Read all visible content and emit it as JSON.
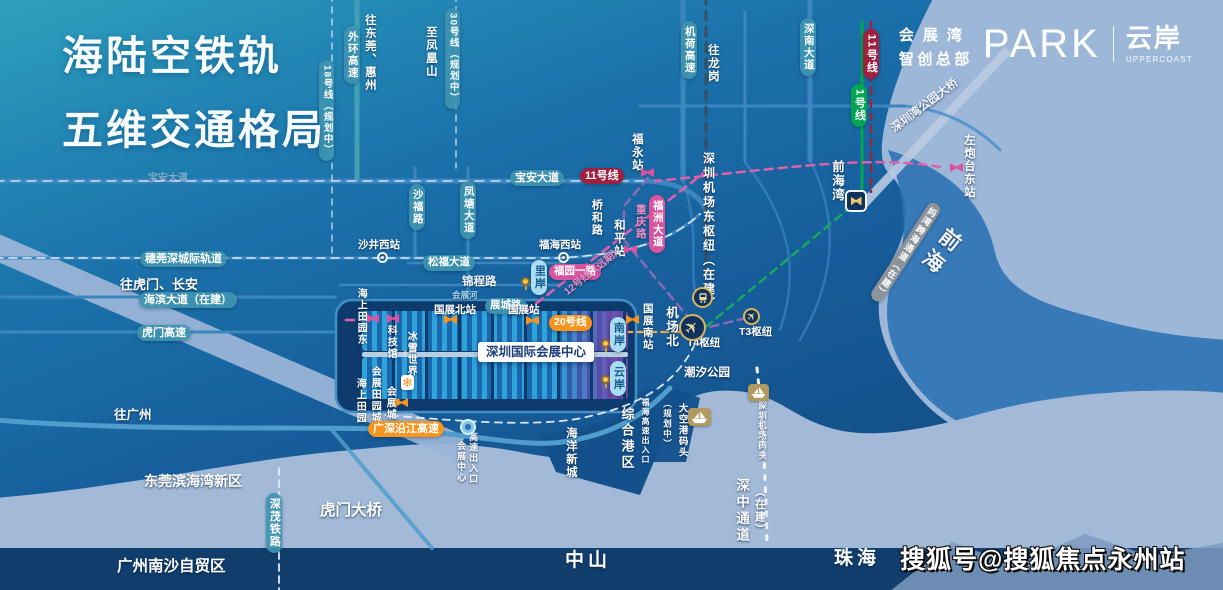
{
  "title": {
    "line1": "海陆空铁轨",
    "line2": "五维交通格局"
  },
  "logo": {
    "line1": "会展湾",
    "line2": "智创总部",
    "park": "PARK",
    "cn2": "云岸",
    "en": "UPPERCOAST"
  },
  "watermark": "搜狐号@搜狐焦点永州站",
  "colors": {
    "sky_teal": "#2fa0bd",
    "land_blue": "#175f9d",
    "sea_light": "#9db7d9",
    "dark_block": "#0d3b6e",
    "road_blue": "#3c86c0",
    "line11_red": "#9e2140",
    "line1_green": "#00a651",
    "line20_orange": "#f7941d",
    "line12_pink": "#d9549f",
    "purple_line": "#8a6bb5",
    "gray_pill": "#8d939a",
    "project_pill": "#aadcf2",
    "gold_icon": "#d9b35e"
  },
  "map": {
    "labels": [
      {
        "n": "waihuan-expwy-pill",
        "t": "外环高速",
        "c": "tl",
        "v": 1,
        "x": 344,
        "y": 26,
        "fs": 10.5
      },
      {
        "n": "line18-pill",
        "t": "18号线（规划中）",
        "c": "tl",
        "v": 1,
        "x": 319,
        "y": 60,
        "fs": 9.5
      },
      {
        "n": "to-dongguan-huizhou-text",
        "t": "往东莞、惠州",
        "c": "tx",
        "v": 1,
        "x": 363,
        "y": 14,
        "fs": 11.5
      },
      {
        "n": "line30-pill",
        "t": "30号线（规划中）",
        "c": "tl",
        "v": 1,
        "x": 445,
        "y": 8,
        "fs": 9.5
      },
      {
        "n": "to-fenghuangshan-text",
        "t": "至凤凰山",
        "c": "tx",
        "v": 1,
        "x": 424,
        "y": 26,
        "fs": 11.5
      },
      {
        "n": "jihe-expwy-pill",
        "t": "机荷高速",
        "c": "tl",
        "v": 1,
        "x": 681,
        "y": 21,
        "fs": 10.5
      },
      {
        "n": "to-longgang-text",
        "t": "往龙岗",
        "c": "tx",
        "v": 1,
        "x": 706,
        "y": 44,
        "fs": 11.5
      },
      {
        "n": "shennan-avenue-pill",
        "t": "深南大道",
        "c": "tl",
        "v": 1,
        "x": 800,
        "y": 18,
        "fs": 10.5
      },
      {
        "n": "line11-pill-vertical",
        "t": "11号线",
        "c": "rd",
        "v": 1,
        "x": 863,
        "y": 29,
        "fs": 11
      },
      {
        "n": "line1-pill",
        "t": "1号线",
        "c": "gn",
        "v": 1,
        "x": 851,
        "y": 84,
        "fs": 11
      },
      {
        "n": "shenzhenwan-park-bridge-text",
        "t": "深圳湾公园大桥",
        "c": "tx",
        "x": 893,
        "y": 124,
        "fs": 11.5,
        "rot": -37,
        "op": 0.9
      },
      {
        "n": "qianhai-sea-text",
        "t": "前海",
        "c": "tx",
        "v": 1,
        "x": 944,
        "y": 230,
        "fs": 21,
        "ls": 6,
        "rot": 38,
        "op": 0.92
      },
      {
        "n": "zuopaotaidong-station-text",
        "t": "左炮台东站",
        "c": "tx",
        "v": 1,
        "x": 962,
        "y": 134,
        "fs": 11.5
      },
      {
        "n": "qianhaiwan-station-text",
        "t": "前海湾",
        "c": "tx",
        "v": 1,
        "x": 830,
        "y": 160,
        "fs": 12.5
      },
      {
        "n": "mawan-crossing-pill",
        "t": "妈湾跨海通道（在建）",
        "c": "gy",
        "v": 1,
        "x": 930,
        "y": 204,
        "fs": 9,
        "rot": 33
      },
      {
        "n": "baoan-avenue-pill",
        "t": "宝安大道",
        "c": "tl",
        "x": 510,
        "y": 170,
        "fs": 11
      },
      {
        "n": "line11-pill-horizontal",
        "t": "11号线",
        "c": "rd",
        "x": 580,
        "y": 168,
        "fs": 11
      },
      {
        "n": "fuyong-station-text",
        "t": "福永站",
        "c": "tx",
        "v": 1,
        "x": 630,
        "y": 133,
        "fs": 11.5
      },
      {
        "n": "shafu-road-pill",
        "t": "沙福路",
        "c": "tl",
        "v": 1,
        "x": 409,
        "y": 184,
        "fs": 10.5
      },
      {
        "n": "fengtang-avenue-pill",
        "t": "凤塘大道",
        "c": "tl",
        "v": 1,
        "x": 460,
        "y": 181,
        "fs": 10.5
      },
      {
        "n": "qiaohe-road-text",
        "t": "桥和路",
        "c": "tx",
        "v": 1,
        "x": 590,
        "y": 199,
        "fs": 11
      },
      {
        "n": "chongqing-road-text",
        "t": "重庆路",
        "c": "tp",
        "v": 1,
        "x": 634,
        "y": 204,
        "fs": 10.5
      },
      {
        "n": "fuzhou-avenue-pill",
        "t": "福洲大道",
        "c": "pk",
        "v": 1,
        "x": 649,
        "y": 195,
        "fs": 10.5
      },
      {
        "n": "heping-station-text",
        "t": "和平站",
        "c": "tx",
        "v": 1,
        "x": 612,
        "y": 219,
        "fs": 11.5
      },
      {
        "n": "airport-east-hub-text",
        "t": "深圳机场东枢纽（在建）",
        "c": "tx",
        "v": 1,
        "x": 701,
        "y": 152,
        "fs": 12,
        "ls": 2.5
      },
      {
        "n": "suiwanshen-rail-pill",
        "t": "穗莞深城际轨道",
        "c": "tl",
        "x": 140,
        "y": 251,
        "fs": 11
      },
      {
        "n": "to-humen-changan-text",
        "t": "往虎门、长安",
        "c": "tx",
        "x": 120,
        "y": 278,
        "fs": 13
      },
      {
        "n": "haibin-avenue-pill",
        "t": "海滨大道（在建）",
        "c": "tl",
        "x": 139,
        "y": 292,
        "fs": 11
      },
      {
        "n": "humen-expwy-pill",
        "t": "虎门高速",
        "c": "tl",
        "x": 137,
        "y": 325,
        "fs": 11
      },
      {
        "n": "baoan-avenue-faint-text",
        "t": "宝安大道",
        "c": "tx",
        "x": 148,
        "y": 173,
        "fs": 10,
        "op": 0.4
      },
      {
        "n": "shajingxi-station-text",
        "t": "沙井西站",
        "c": "tx",
        "x": 358,
        "y": 240,
        "fs": 10.5
      },
      {
        "n": "fuhaixi-station-text",
        "t": "福海西站",
        "c": "tx",
        "x": 539,
        "y": 240,
        "fs": 10.5
      },
      {
        "n": "songfu-avenue-pill",
        "t": "松福大道",
        "c": "tl",
        "x": 423,
        "y": 255,
        "fs": 10.5
      },
      {
        "n": "jincheng-road-text",
        "t": "锦程路",
        "c": "tx",
        "x": 462,
        "y": 276,
        "fs": 11.5,
        "op": 0.95
      },
      {
        "n": "huizhan-river-text",
        "t": "会展河",
        "c": "ts",
        "x": 452,
        "y": 291,
        "fs": 8.5
      },
      {
        "n": "zhancheng-road-pill",
        "t": "展城路",
        "c": "tl",
        "x": 485,
        "y": 298,
        "fs": 10.5
      },
      {
        "n": "guozhanbei-station-text",
        "t": "国展北站",
        "c": "tx",
        "x": 434,
        "y": 305,
        "fs": 10.5
      },
      {
        "n": "guozhan-station-text",
        "t": "国展站",
        "c": "tx",
        "x": 508,
        "y": 305,
        "fs": 10.5
      },
      {
        "n": "line20-pill",
        "t": "20号线",
        "c": "or",
        "x": 549,
        "y": 315,
        "fs": 10.5
      },
      {
        "n": "guozhannan-station-text",
        "t": "国展南站",
        "c": "tx",
        "v": 1,
        "x": 641,
        "y": 303,
        "fs": 10.5
      },
      {
        "n": "fuyuan-yilu-pill",
        "t": "福园一路",
        "c": "pk",
        "x": 549,
        "y": 264,
        "fs": 10.5
      },
      {
        "n": "line12-future-label",
        "t": "12号线（远期）",
        "c": "tp",
        "x": 566,
        "y": 288,
        "fs": 10,
        "rot": -39
      },
      {
        "n": "haishangtianyuandong-station-text",
        "t": "海上田园东",
        "c": "tx",
        "v": 1,
        "x": 355,
        "y": 288,
        "fs": 10
      },
      {
        "n": "kejiguan-station-text",
        "t": "科技馆",
        "c": "tx",
        "v": 1,
        "x": 385,
        "y": 325,
        "fs": 10
      },
      {
        "n": "bingxueshijie-text",
        "t": "冰雪世界",
        "c": "tx",
        "v": 1,
        "x": 405,
        "y": 331,
        "fs": 10
      },
      {
        "n": "huizhantianyuancheng-text",
        "t": "会展田园城",
        "c": "tx",
        "v": 1,
        "x": 369,
        "y": 366,
        "fs": 10
      },
      {
        "n": "haishangtianyuan-text",
        "t": "海上田园",
        "c": "tx",
        "v": 1,
        "x": 354,
        "y": 378,
        "fs": 10
      },
      {
        "n": "huizhancheng-station-text",
        "t": "会展城",
        "c": "tx",
        "v": 1,
        "x": 384,
        "y": 386,
        "fs": 10
      },
      {
        "n": "convention-center-box",
        "t": "深圳国际会展中心",
        "c": "box",
        "x": 478,
        "y": 342
      },
      {
        "n": "lian-project-pill",
        "t": "里岸",
        "c": "lt",
        "v": 1,
        "x": 531,
        "y": 260,
        "fs": 11
      },
      {
        "n": "nanan-project-pill",
        "t": "南岸",
        "c": "lt",
        "v": 1,
        "x": 610,
        "y": 317,
        "fs": 11
      },
      {
        "n": "yunan-project-pill",
        "t": "云岸",
        "c": "lt",
        "v": 1,
        "x": 610,
        "y": 361,
        "fs": 11
      },
      {
        "n": "jichangbei-station-text",
        "t": "机场北",
        "c": "tx",
        "v": 1,
        "x": 664,
        "y": 306,
        "fs": 12.5
      },
      {
        "n": "t4-hub-text",
        "t": "T4枢纽",
        "c": "tx",
        "x": 687,
        "y": 338,
        "fs": 10.5
      },
      {
        "n": "t3-hub-text",
        "t": "T3枢纽",
        "c": "tx",
        "x": 739,
        "y": 327,
        "fs": 10.5
      },
      {
        "n": "chaoxi-park-text",
        "t": "潮汐公园",
        "c": "tx",
        "x": 684,
        "y": 367,
        "fs": 11.5
      },
      {
        "n": "guangshen-yanjiang-expwy-pill",
        "t": "广深沿江高速",
        "c": "or",
        "x": 368,
        "y": 421,
        "fs": 11
      },
      {
        "n": "expwy-exit-text",
        "t": "高速出入口",
        "c": "tx",
        "v": 1,
        "x": 468,
        "y": 432,
        "fs": 9
      },
      {
        "n": "expwy-exit-huizhan-text",
        "t": "会展中心",
        "c": "tx",
        "v": 1,
        "x": 456,
        "y": 441,
        "fs": 9
      },
      {
        "n": "haiyang-xincheng-text",
        "t": "海洋新城",
        "c": "tx",
        "v": 1,
        "x": 564,
        "y": 427,
        "fs": 11.5
      },
      {
        "n": "zonghe-gangqu-text",
        "t": "综合港区",
        "c": "tx",
        "v": 1,
        "x": 619,
        "y": 407,
        "fs": 13,
        "ls": 3
      },
      {
        "n": "fuhai-expwy-exit-text",
        "t": "福海高速出入口",
        "c": "tx",
        "v": 1,
        "x": 640,
        "y": 398,
        "fs": 8
      },
      {
        "n": "guihuazhong-text",
        "t": "（规划中）",
        "c": "tx",
        "v": 1,
        "x": 662,
        "y": 399,
        "fs": 8.5
      },
      {
        "n": "dakonggang-ferry-text",
        "t": "大空港码头",
        "c": "tx",
        "v": 1,
        "x": 676,
        "y": 403,
        "fs": 9.5
      },
      {
        "n": "airport-ferry-text",
        "t": "深圳机场码头",
        "c": "tx",
        "v": 1,
        "x": 757,
        "y": 401,
        "fs": 8.5
      },
      {
        "n": "shenzhong-corridor-text",
        "t": "深中通道",
        "c": "tx",
        "v": 1,
        "x": 734,
        "y": 478,
        "fs": 13.5,
        "ls": 3
      },
      {
        "n": "shenzhong-corridor-sub-text",
        "t": "（在建）",
        "c": "tx",
        "v": 1,
        "x": 753,
        "y": 486,
        "fs": 11
      },
      {
        "n": "shenmao-railway-pill",
        "t": "深茂铁路",
        "c": "tl",
        "v": 1,
        "x": 266,
        "y": 493,
        "fs": 11
      },
      {
        "n": "to-guangzhou-text",
        "t": "往广州",
        "c": "tx",
        "x": 114,
        "y": 408,
        "fs": 12.5
      },
      {
        "n": "dongguan-binhaiwan-text",
        "t": "东莞滨海湾新区",
        "c": "tx",
        "x": 144,
        "y": 474,
        "fs": 14
      },
      {
        "n": "humen-bridge-text",
        "t": "虎门大桥",
        "c": "tx",
        "x": 320,
        "y": 502,
        "fs": 15.5
      },
      {
        "n": "guangzhou-nansha-text",
        "t": "广州南沙自贸区",
        "c": "tx",
        "x": 117,
        "y": 558,
        "fs": 15.5
      },
      {
        "n": "zhongshan-city-text",
        "t": "中山",
        "c": "big",
        "x": 565,
        "y": 550
      },
      {
        "n": "zhuhai-city-text",
        "t": "珠海",
        "c": "big",
        "x": 834,
        "y": 548
      }
    ],
    "markers": [
      {
        "n": "fuyong-station-marker",
        "k": "x",
        "x": 641,
        "y": 168,
        "c": "#e0519f",
        "s": 13
      },
      {
        "n": "heping-station-marker",
        "k": "x",
        "x": 624,
        "y": 245,
        "c": "#e0519f",
        "s": 13
      },
      {
        "n": "zuopaotaidong-station-marker",
        "k": "x",
        "x": 950,
        "y": 163,
        "c": "#e0519f",
        "s": 13
      },
      {
        "n": "haishangtianyuandong-station-marker",
        "k": "x",
        "x": 367,
        "y": 314,
        "c": "#e0519f",
        "s": 12
      },
      {
        "n": "kejiguan-station-marker",
        "k": "x",
        "x": 387,
        "y": 314,
        "c": "#e0519f",
        "s": 12
      },
      {
        "n": "guozhanbei-station-marker",
        "k": "x",
        "x": 444,
        "y": 315,
        "c": "#f7941d",
        "s": 13
      },
      {
        "n": "guozhan-station-marker",
        "k": "x",
        "x": 526,
        "y": 316,
        "c": "#f7941d",
        "s": 13
      },
      {
        "n": "guozhannan-station-marker",
        "k": "x",
        "x": 626,
        "y": 315,
        "c": "#f7941d",
        "s": 13
      },
      {
        "n": "huizhancheng-station-marker",
        "k": "x",
        "x": 395,
        "y": 398,
        "c": "#f7941d",
        "s": 13
      },
      {
        "n": "shajingxi-station-marker",
        "k": "ring",
        "x": 377,
        "y": 252,
        "s": 11
      },
      {
        "n": "fuhaixi-station-marker",
        "k": "ring",
        "x": 558,
        "y": 252,
        "s": 11
      },
      {
        "n": "qianhaiwan-interchange-icon",
        "k": "inter",
        "x": 845,
        "y": 190,
        "s": 22
      },
      {
        "n": "t4-airport-icon",
        "k": "plane",
        "x": 679,
        "y": 314,
        "s": 27
      },
      {
        "n": "t3-airport-icon",
        "k": "plane",
        "x": 743,
        "y": 308,
        "s": 17
      },
      {
        "n": "jichangbei-metro-icon",
        "k": "train",
        "x": 692,
        "y": 287,
        "s": 21
      },
      {
        "n": "dakonggang-ferry-icon",
        "k": "ship",
        "x": 688,
        "y": 408,
        "s": 23
      },
      {
        "n": "airport-ferry-icon",
        "k": "ship",
        "x": 748,
        "y": 384,
        "s": 21
      },
      {
        "n": "lian-project-pin",
        "k": "pin",
        "x": 521,
        "y": 277
      },
      {
        "n": "nanan-project-pin",
        "k": "pin",
        "x": 601,
        "y": 339
      },
      {
        "n": "yunan-project-pin",
        "k": "pin",
        "x": 601,
        "y": 375
      },
      {
        "n": "snowworld-icon",
        "k": "snow",
        "x": 401,
        "y": 375,
        "s": 13
      },
      {
        "n": "highway-exit-icon",
        "k": "ent",
        "x": 460,
        "y": 419,
        "s": 16
      }
    ]
  }
}
